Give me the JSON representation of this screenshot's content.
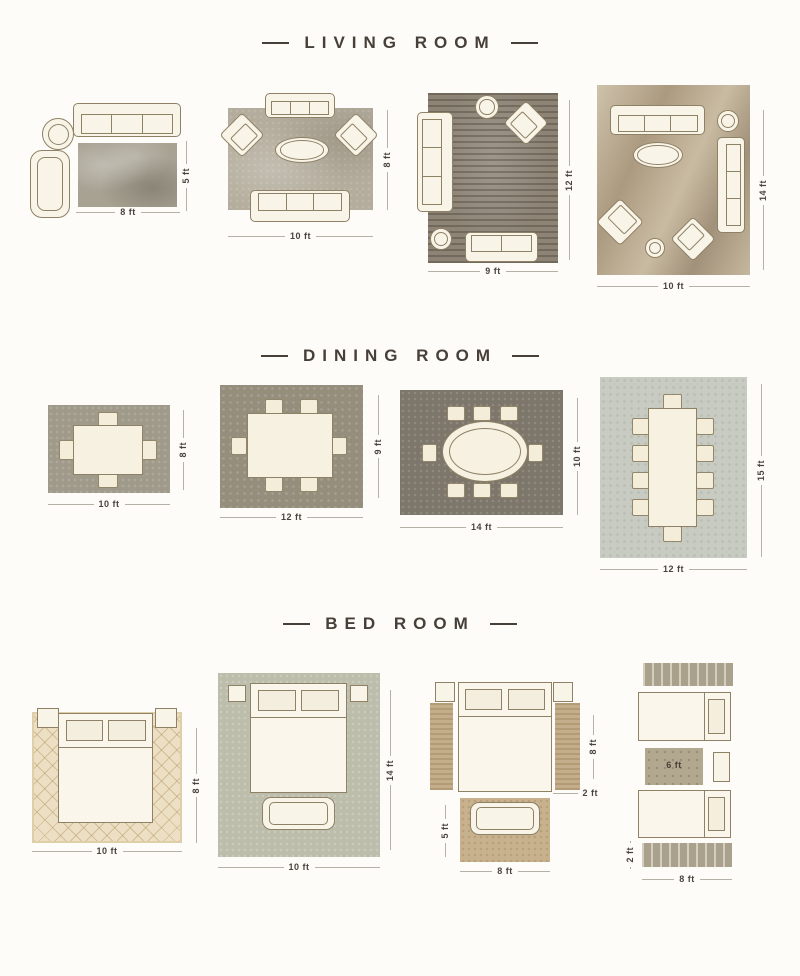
{
  "sections": {
    "living_room": {
      "title": "LIVING ROOM",
      "layouts": [
        {
          "width": "8 ft",
          "height": "5 ft"
        },
        {
          "width": "10 ft",
          "height": "8 ft"
        },
        {
          "width": "9 ft",
          "height": "12 ft"
        },
        {
          "width": "10 ft",
          "height": "14 ft"
        }
      ]
    },
    "dining_room": {
      "title": "DINING ROOM",
      "layouts": [
        {
          "width": "10 ft",
          "height": "8 ft"
        },
        {
          "width": "12 ft",
          "height": "9 ft"
        },
        {
          "width": "14 ft",
          "height": "10 ft"
        },
        {
          "width": "12 ft",
          "height": "15 ft"
        }
      ]
    },
    "bed_room": {
      "title": "BED ROOM",
      "layouts": [
        {
          "width": "10 ft",
          "height": "8 ft"
        },
        {
          "width": "10 ft",
          "height": "14 ft"
        },
        {
          "bed_height": "8 ft",
          "runner_width": "2 ft",
          "foot_rug_height": "5 ft",
          "foot_rug_width": "8 ft"
        },
        {
          "middle_rug_label": "6 ft",
          "runner_height": "2 ft",
          "width": "8 ft"
        }
      ]
    }
  }
}
